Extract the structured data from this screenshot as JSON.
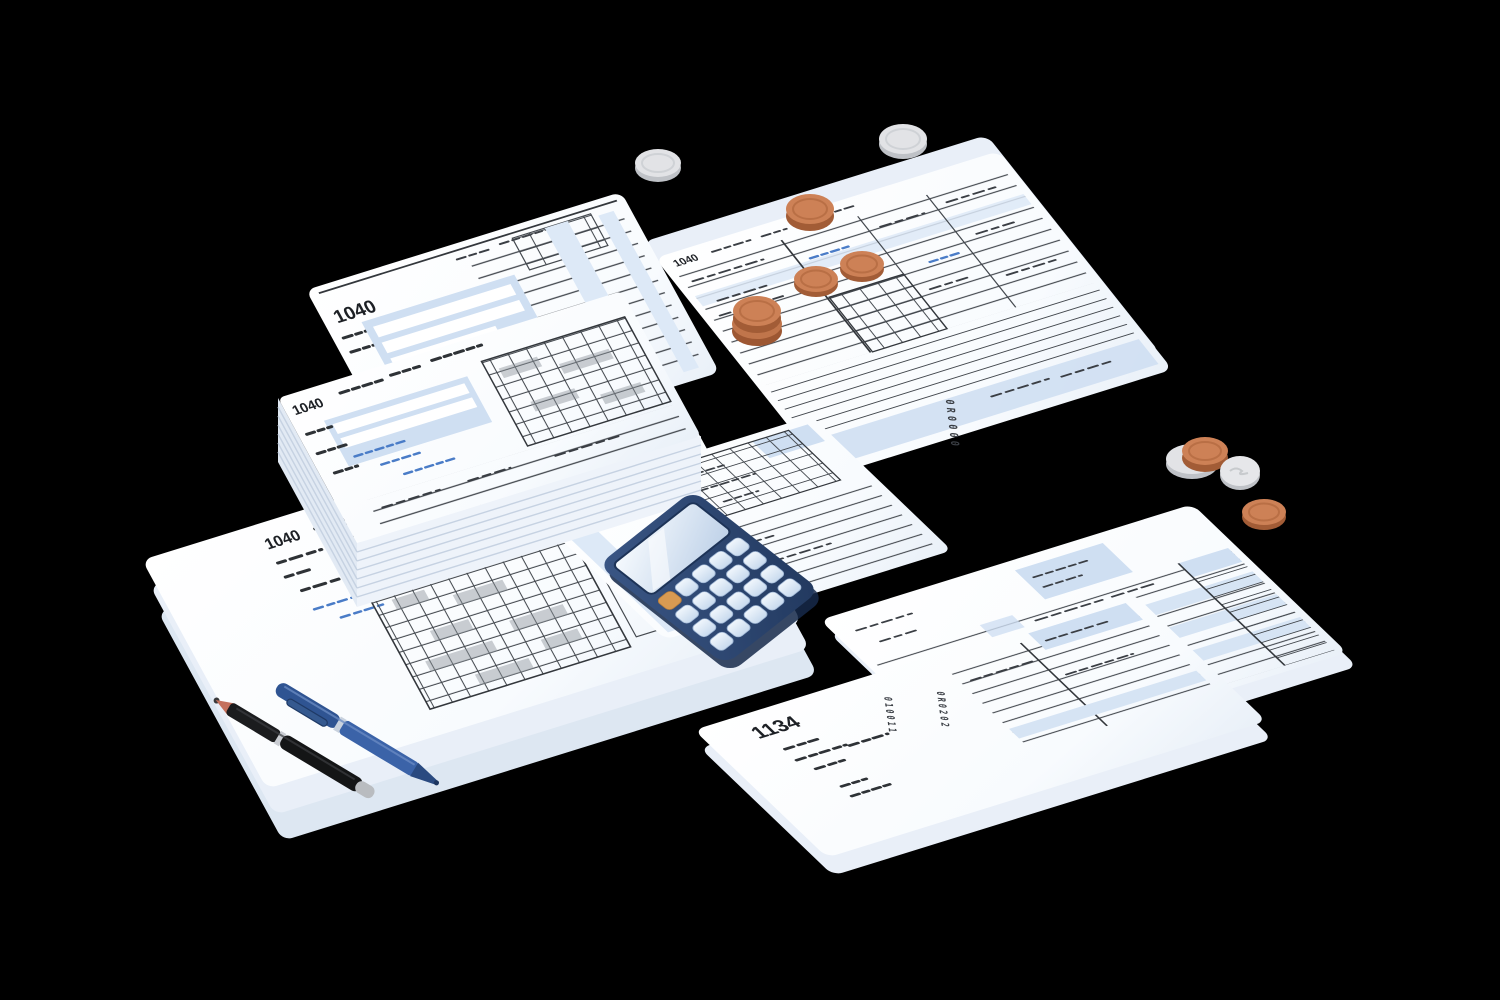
{
  "scene": {
    "description": "Isometric flat illustration of tax paperwork: 1040 tax forms and a stacked pile of forms, an 1134 form, a navy calculator, copper and silver coins, and two pens on a black background",
    "background_color": "#000000"
  },
  "forms": {
    "paper_color": "#fbfdff",
    "field_tint_color": "#cfdff2",
    "rule_line_color": "#43484e",
    "ink_scribble_color": "#2e3236",
    "handwriting_ink_color": "#4a7cc7",
    "top_left_form": {
      "label": "1040"
    },
    "stacked_form": {
      "label": "1040"
    },
    "bottom_left_form": {
      "label": "1040"
    },
    "top_right_form": {
      "label": "1040",
      "edge_code": "0R0000"
    },
    "bottom_form": {
      "label": "1134",
      "edge_code_left": "010011",
      "edge_code_right": "0R0202"
    }
  },
  "calculator": {
    "body_color": "#2c4770",
    "display_color": "#e9f2fb",
    "key_color": "#dce8f6",
    "accent_key_color": "#d99a4e",
    "key_rows": 4,
    "key_columns": 5
  },
  "coins": {
    "copper_color": "#cd8156",
    "silver_color": "#e2e3e6",
    "copper_count": 7,
    "silver_count": 4
  },
  "pens": {
    "black_pen": {
      "body_color": "#17181a",
      "tip_color": "#c4705c",
      "cap_color": "#b9bcc0"
    },
    "blue_pen": {
      "body_color": "#3b63a8",
      "tip_color": "#22406e"
    }
  }
}
